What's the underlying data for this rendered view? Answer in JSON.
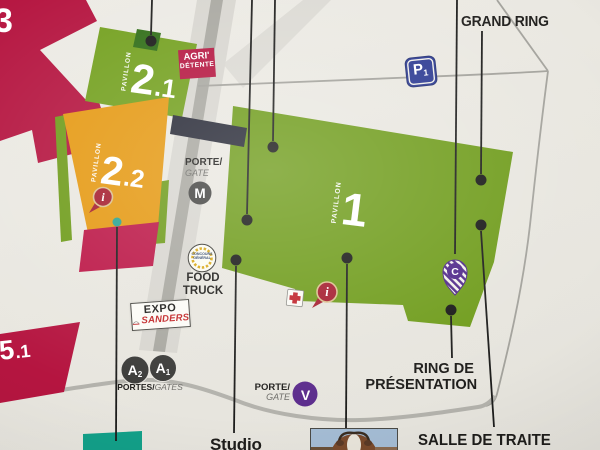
{
  "pavilions": {
    "p3": {
      "label": "3"
    },
    "p51": {
      "major": "5",
      "minor": ".1"
    },
    "p21": {
      "side": "PAVILLON",
      "major": "2",
      "minor": ".1"
    },
    "p22": {
      "side": "PAVILLON",
      "major": "2",
      "minor": ".2"
    },
    "p1": {
      "side": "PAVILLON",
      "major": "1"
    }
  },
  "badges": {
    "agri_line1": "AGRI'",
    "agri_line2": "DÉTENTE"
  },
  "gates": {
    "m_porte": "PORTE/",
    "m_gate": "GATE",
    "m_letter": "M",
    "v_porte": "PORTE/",
    "v_gate": "GATE",
    "v_letter": "V",
    "a_portes": "PORTES/",
    "a_gates": "GATES",
    "a2_letter": "A",
    "a2_sub": "2",
    "a1_letter": "A",
    "a1_sub": "1"
  },
  "parking": {
    "letter": "P",
    "sub": "1"
  },
  "labels": {
    "grand_ring": "GRAND RING",
    "studio": "Studio",
    "ring_line1": "RING DE",
    "ring_line2": "PRÉSENTATION",
    "salle_de_traite": "SALLE DE TRAITE",
    "food_line1": "FOOD",
    "food_line2": "TRUCK"
  },
  "expo": {
    "title": "EXPO",
    "brand": "SANDERS"
  },
  "logo": {
    "line1": "CONCOURS",
    "line2": "GÉNÉRAL"
  },
  "pins": {
    "c_letter": "C",
    "info": "i"
  },
  "colors": {
    "crimson": "#b51540",
    "green": "#6f9c1b",
    "dark_green": "#2f6d16",
    "orange": "#e59912",
    "teal": "#12a089",
    "navy": "#2c3a92",
    "purple": "#5b2b8c",
    "info_red": "#a51d2f",
    "background": "#e9e7e0"
  }
}
